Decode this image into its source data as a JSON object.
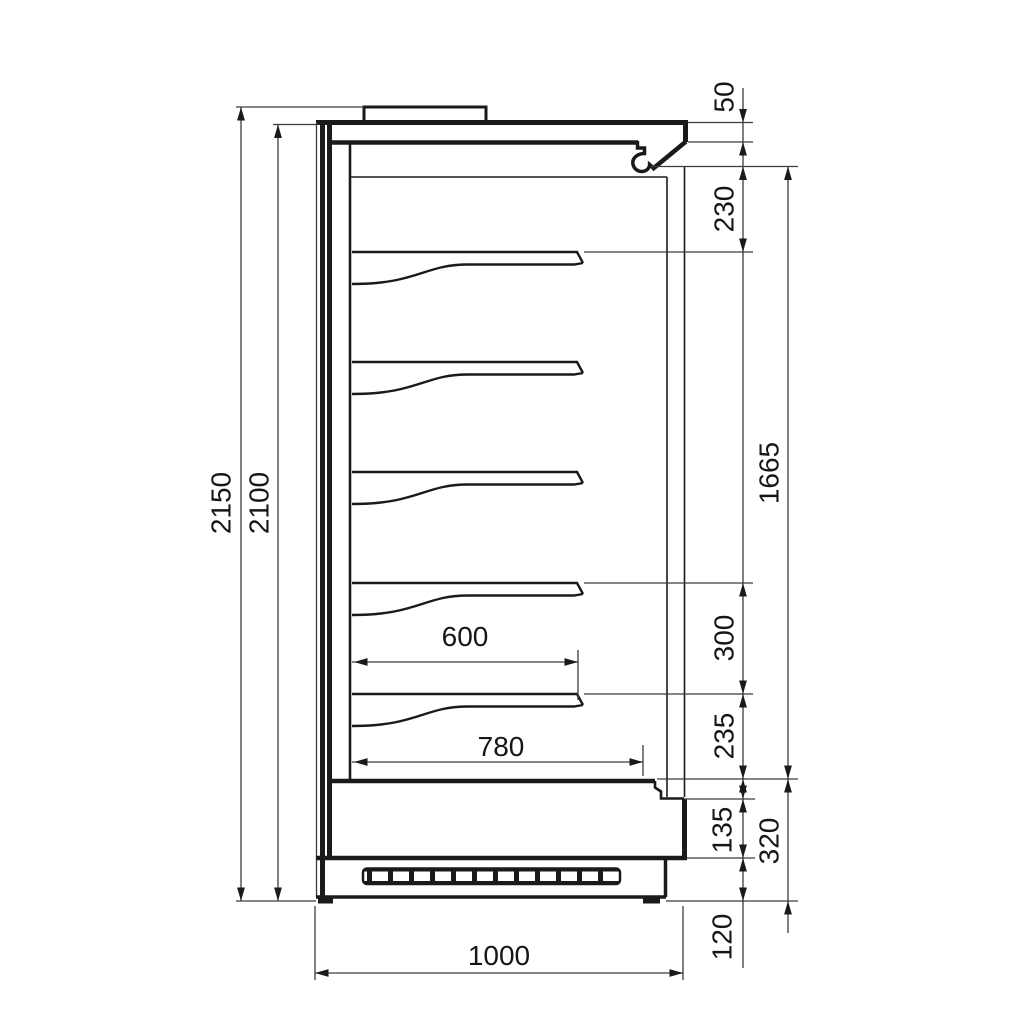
{
  "drawing": {
    "kind": "technical side cross-section of multideck display cabinet",
    "shelf_count": 5,
    "colors": {
      "line": "#1a1a1a",
      "background": "#ffffff"
    }
  },
  "dims": {
    "overall_height": "2150",
    "body_height": "2100",
    "canopy_front": "50",
    "canopy_to_first_shelf": "230",
    "display_opening_height": "1665",
    "shelf_pitch": "300",
    "last_shelf_to_deck": "235",
    "front_lower_panel": "135",
    "bottom_section": "320",
    "plinth_height": "120",
    "shelf_depth": "600",
    "deck_depth": "780",
    "overall_depth": "1000"
  }
}
